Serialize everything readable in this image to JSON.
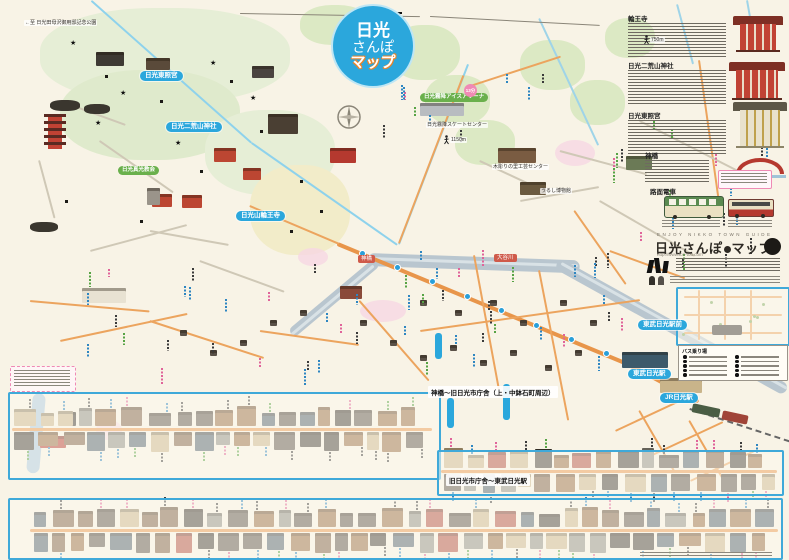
{
  "title_logo": {
    "line1": "日光",
    "line2": "さんぽ",
    "line3": "マップ"
  },
  "sidebar": {
    "sections": [
      {
        "heading": "輪王寺"
      },
      {
        "heading": "日光二荒山神社"
      },
      {
        "heading": "日光東照宮"
      },
      {
        "heading": "神橋"
      },
      {
        "heading": "路面電車"
      }
    ],
    "guide": {
      "eyebrow": "ENJOY NIKKO TOWN GUIDE",
      "title_a": "日光さんぽ",
      "title_b": "マップ",
      "url": "http://www.ton-tou.com"
    }
  },
  "map": {
    "blue_pills": [
      {
        "label": "日光東照宮",
        "x": 140,
        "y": 71
      },
      {
        "label": "日光二荒山神社",
        "x": 166,
        "y": 122
      },
      {
        "label": "日光山輪王寺",
        "x": 236,
        "y": 211
      },
      {
        "label": "東武日光駅前",
        "x": 638,
        "y": 320
      },
      {
        "label": "東武日光駅",
        "x": 628,
        "y": 369
      },
      {
        "label": "JR日光駅",
        "x": 660,
        "y": 393
      }
    ],
    "green_pills": [
      {
        "label": "日光霧降アイスアリーナ",
        "x": 420,
        "y": 93
      },
      {
        "label": "日光真光教会",
        "x": 118,
        "y": 166
      }
    ],
    "small_labels": [
      {
        "label": "←至 日光田母沢御用邸記念公園",
        "x": 24,
        "y": 20
      },
      {
        "label": "日光霧降スケートセンター",
        "x": 426,
        "y": 122
      },
      {
        "label": "木彫りの里工芸センター",
        "x": 492,
        "y": 164
      },
      {
        "label": "うるし博物館",
        "x": 540,
        "y": 188
      },
      {
        "label": "1150m",
        "x": 450,
        "y": 137
      },
      {
        "label": "750m",
        "x": 650,
        "y": 37
      }
    ],
    "spot_labels": [
      {
        "label": "神橋",
        "x": 358,
        "y": 255
      },
      {
        "label": "大谷川",
        "x": 494,
        "y": 254
      }
    ],
    "walk_time": {
      "label": "13分",
      "x": 464,
      "y": 84
    },
    "bus_box_header": "バス乗り場"
  },
  "strips": {
    "title1": "神橋～旧日光市庁舎（上・中鉢石町周辺）",
    "title2": "旧日光市庁舎～東武日光駅"
  }
}
